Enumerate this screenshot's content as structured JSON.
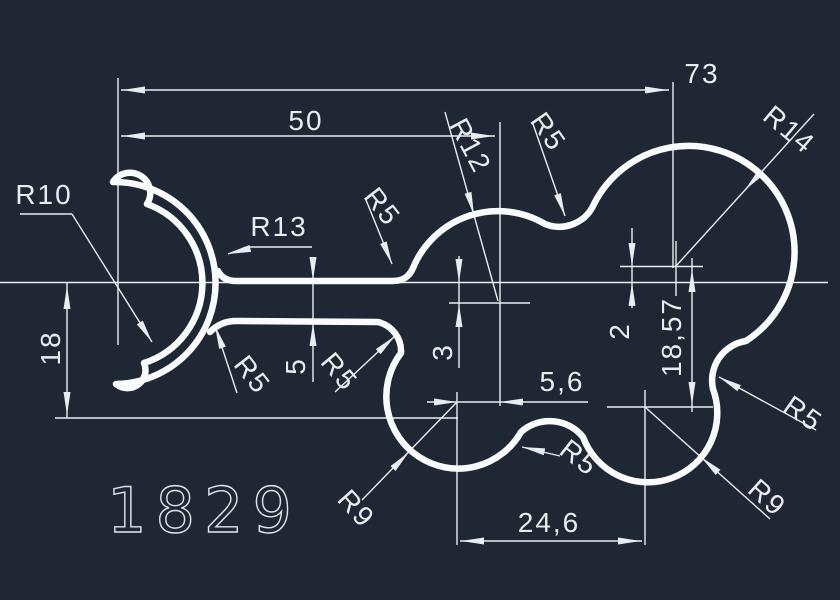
{
  "drawing": {
    "part_number": "1829",
    "background_color": "#202734",
    "line_color": "#e9edf2",
    "profile_color": "#fafbfd",
    "dimensions": {
      "width_total": "73",
      "width_upper": "50",
      "height_left": "18",
      "slot_gap": "5",
      "wall_thickness": "3",
      "center_offset": "2",
      "height_right": "18,57",
      "lobe_offset": "5,6",
      "lobe_spacing": "24,6"
    },
    "radii": {
      "r10": "R10",
      "r13": "R13",
      "r5_top_left": "R5",
      "r12": "R12",
      "r5_top_mid": "R5",
      "r14": "R14",
      "r5_right": "R5",
      "r9_right": "R9",
      "r9_left": "R9",
      "r5_bump": "R5",
      "r5_slot": "R5",
      "r5_left": "R5"
    }
  }
}
